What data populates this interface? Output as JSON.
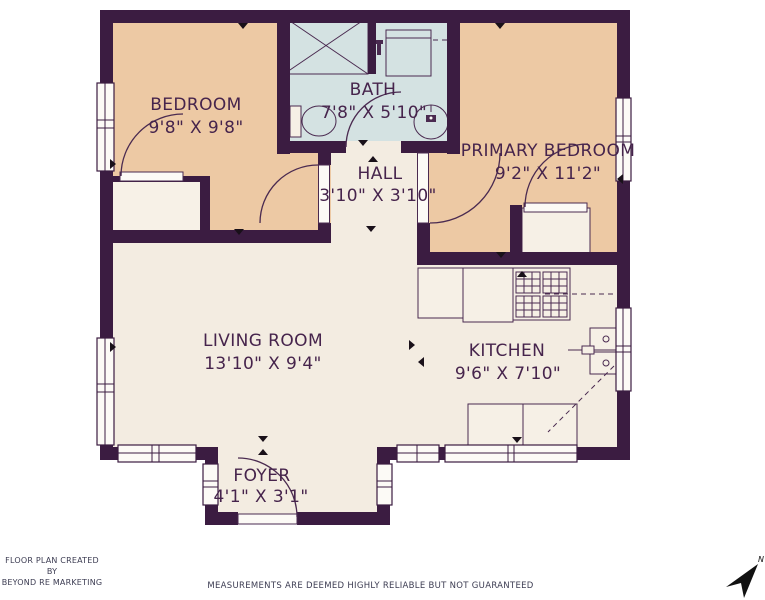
{
  "plan": {
    "rooms": [
      {
        "name": "BEDROOM",
        "dims": "9'8\" X 9'8\""
      },
      {
        "name": "BATH",
        "dims": "7'8\" X 5'10\""
      },
      {
        "name": "HALL",
        "dims": "3'10\" X 3'10\""
      },
      {
        "name": "PRIMARY BEDROOM",
        "dims": "9'2\" X 11'2\""
      },
      {
        "name": "LIVING ROOM",
        "dims": "13'10\" X 9'4\""
      },
      {
        "name": "KITCHEN",
        "dims": "9'6\" X 7'10\""
      },
      {
        "name": "FOYER",
        "dims": "4'1\" X 3'1\""
      }
    ],
    "north_label": "N",
    "colors": {
      "wall": "#3b1c41",
      "bedroom_fill": "#edc9a4",
      "bath_fill": "#d4e2e2",
      "neutral_fill": "#f3ece1",
      "label_text": "#46244c"
    }
  },
  "footer": {
    "credit_line1": "FLOOR PLAN CREATED BY",
    "credit_line2": "BEYOND RE MARKETING",
    "disclaimer": "MEASUREMENTS ARE DEEMED HIGHLY RELIABLE BUT NOT GUARANTEED"
  }
}
